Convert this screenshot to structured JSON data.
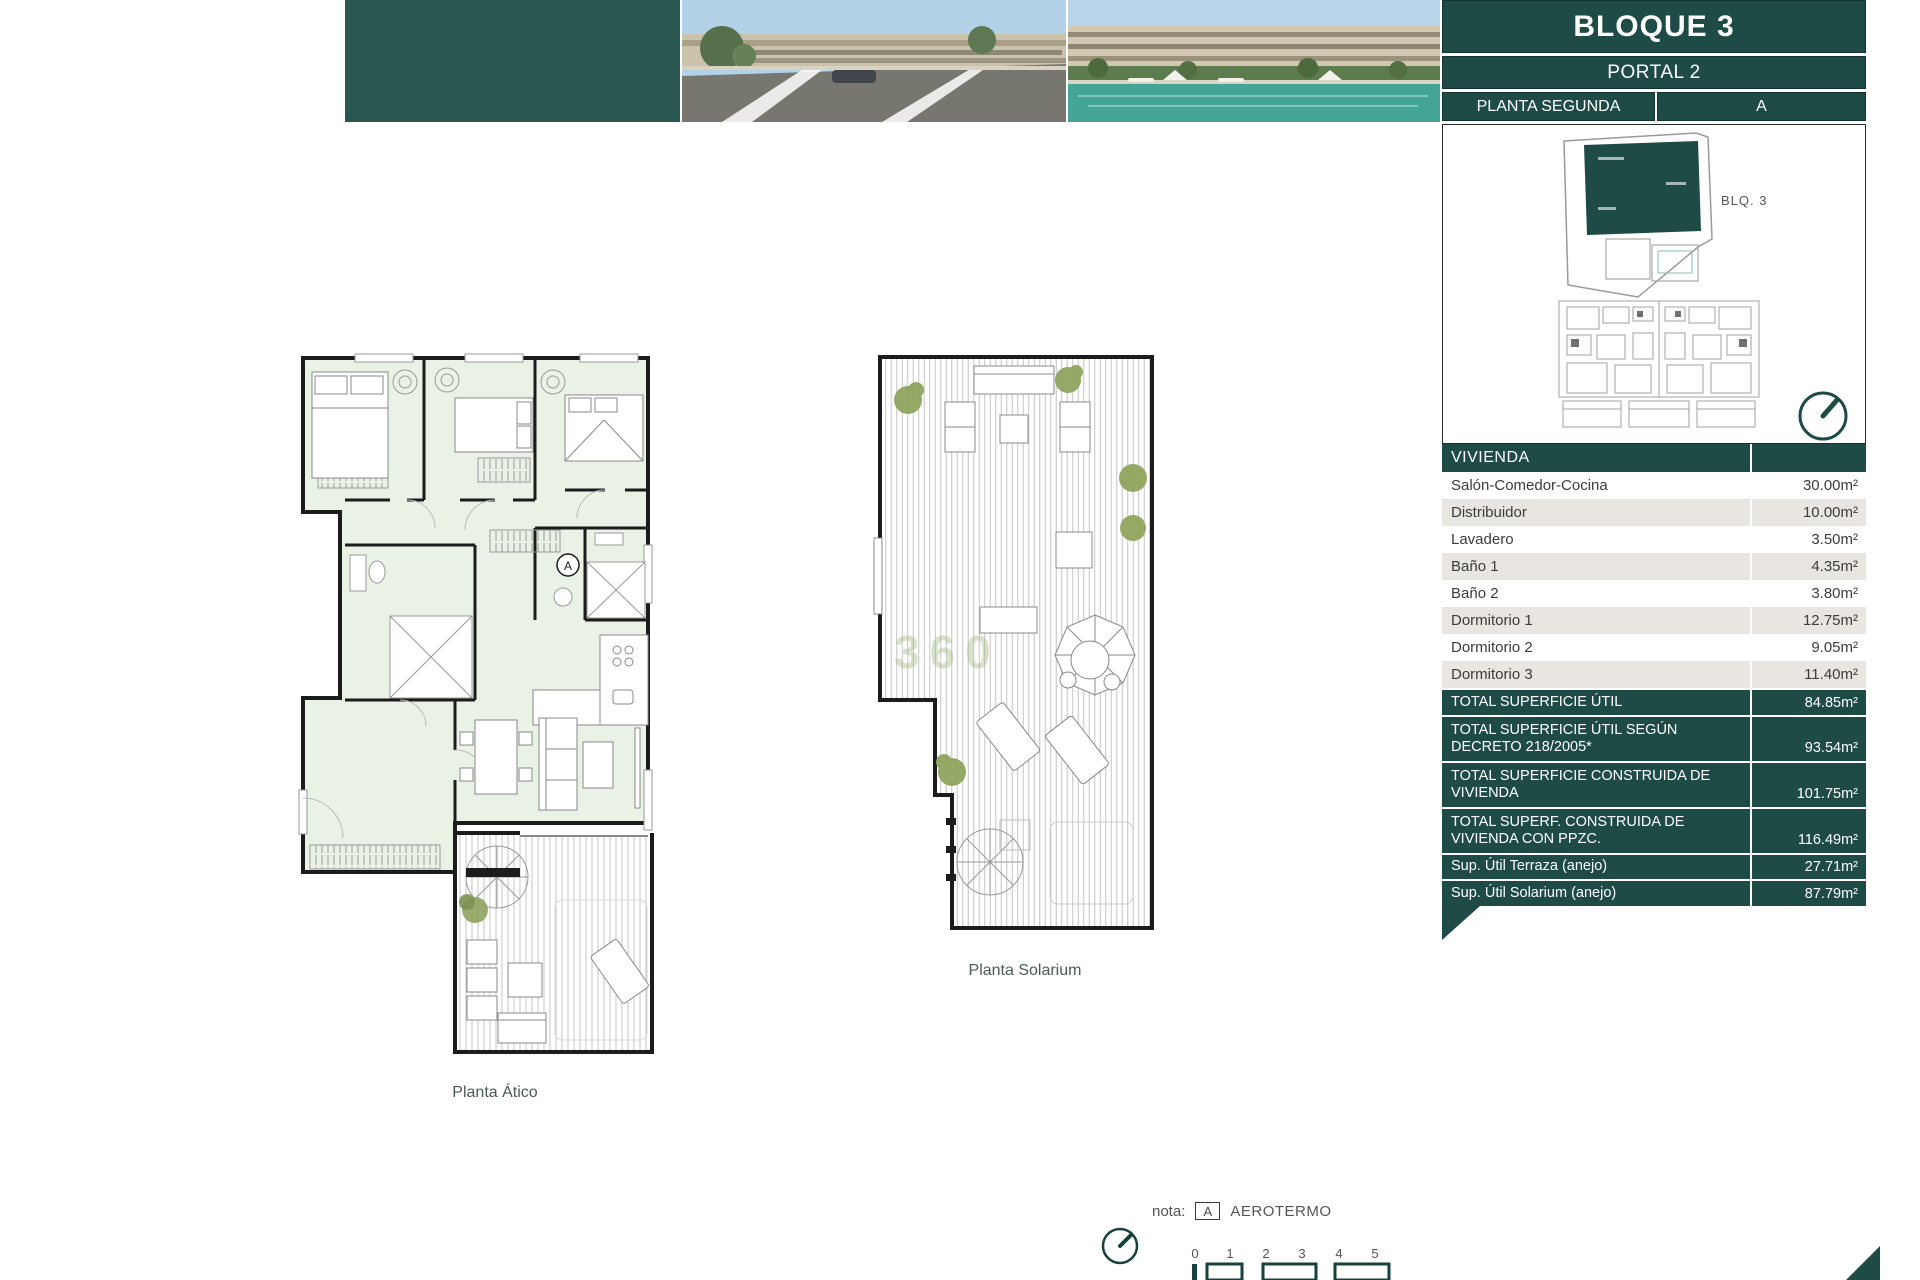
{
  "header": {
    "title": "BLOQUE 3",
    "portal": "PORTAL 2",
    "planta": "PLANTA SEGUNDA",
    "letter": "A",
    "site_label": "BLQ. 3"
  },
  "table": {
    "header": "VIVIENDA",
    "rows": [
      {
        "label": "Salón-Comedor-Cocina",
        "value": "30.00m²"
      },
      {
        "label": "Distribuidor",
        "value": "10.00m²"
      },
      {
        "label": "Lavadero",
        "value": "3.50m²"
      },
      {
        "label": "Baño 1",
        "value": "4.35m²"
      },
      {
        "label": "Baño 2",
        "value": "3.80m²"
      },
      {
        "label": "Dormitorio 1",
        "value": "12.75m²"
      },
      {
        "label": "Dormitorio 2",
        "value": "9.05m²"
      },
      {
        "label": "Dormitorio 3",
        "value": "11.40m²"
      }
    ],
    "totals": [
      {
        "label": "TOTAL SUPERFICIE ÚTIL",
        "value": "84.85m²"
      },
      {
        "label": "TOTAL SUPERFICIE ÚTIL SEGÚN DECRETO 218/2005*",
        "value": "93.54m²"
      },
      {
        "label": "TOTAL SUPERFICIE CONSTRUIDA DE VIVIENDA",
        "value": "101.75m²"
      },
      {
        "label": "TOTAL SUPERF. CONSTRUIDA DE VIVIENDA CON PPZC.",
        "value": "116.49m²"
      },
      {
        "label": "Sup. Útil Terraza (anejo)",
        "value": "27.71m²"
      },
      {
        "label": "Sup. Útil Solarium (anejo)",
        "value": "87.79m²"
      }
    ]
  },
  "plans": {
    "atico_label": "Planta Ático",
    "solarium_label": "Planta Solarium",
    "aerotermo_marker": "A",
    "nota_prefix": "nota:",
    "nota_text": "AEROTERMO",
    "watermark": "360",
    "scale_ticks": [
      "0",
      "1",
      "2",
      "3",
      "4",
      "5"
    ]
  },
  "notes": {
    "title": "NOTAS:",
    "paragraphs": [
      "La superficie útil total de la vivienda es la suma de la superficie útil interior más la superficie útil de terrazas cubiertas y descubiertas (no incluye solariums, terrazas anejos, ni jardines y terrazas de planta baja).",
      "La superficie construida total de vivienda es la suma de la superficie útil total y la superficie de los muros y tabiques, midiéndose a ejes los tabiques en aquellos que son separadores con zonas comunes u otras viviendas, y por el exterior cuando se trata de fachadas.",
      "La superficie construida total de vivienda con PPZC, es la suma de la superficie construida de vivienda y la parte proporcional de zonas comunes.",
      "El comprador de una vivienda con solarium y/o terraza anejo y/o terraza jardín anejo tiene sobre los mismos el derecho de uso y disfrute así como la obligación de mantenimiento y limpieza. El comprador de una vivienda con jardín privativo tiene el derecho privativo y exclusivo sobre el mismo.",
      "Las superficies son aproximadas y susceptibles de modificaciones sobre las superficies señaladas por exigencias municipales, por criterios normativos y/o técnicos. El mobiliario y la vegetación tienen únicamente efecto decorativo y no están incluidos.",
      "(*) Anexo 1. Reglamento de información al consumidor en la compraventa y arrendamiento de viviendas en Andalucía."
    ]
  },
  "colors": {
    "teal_dark": "#1f4b46",
    "teal_block": "#2b5751",
    "row_alt": "#e9e6e1",
    "room_fill": "#eaf2e6"
  }
}
